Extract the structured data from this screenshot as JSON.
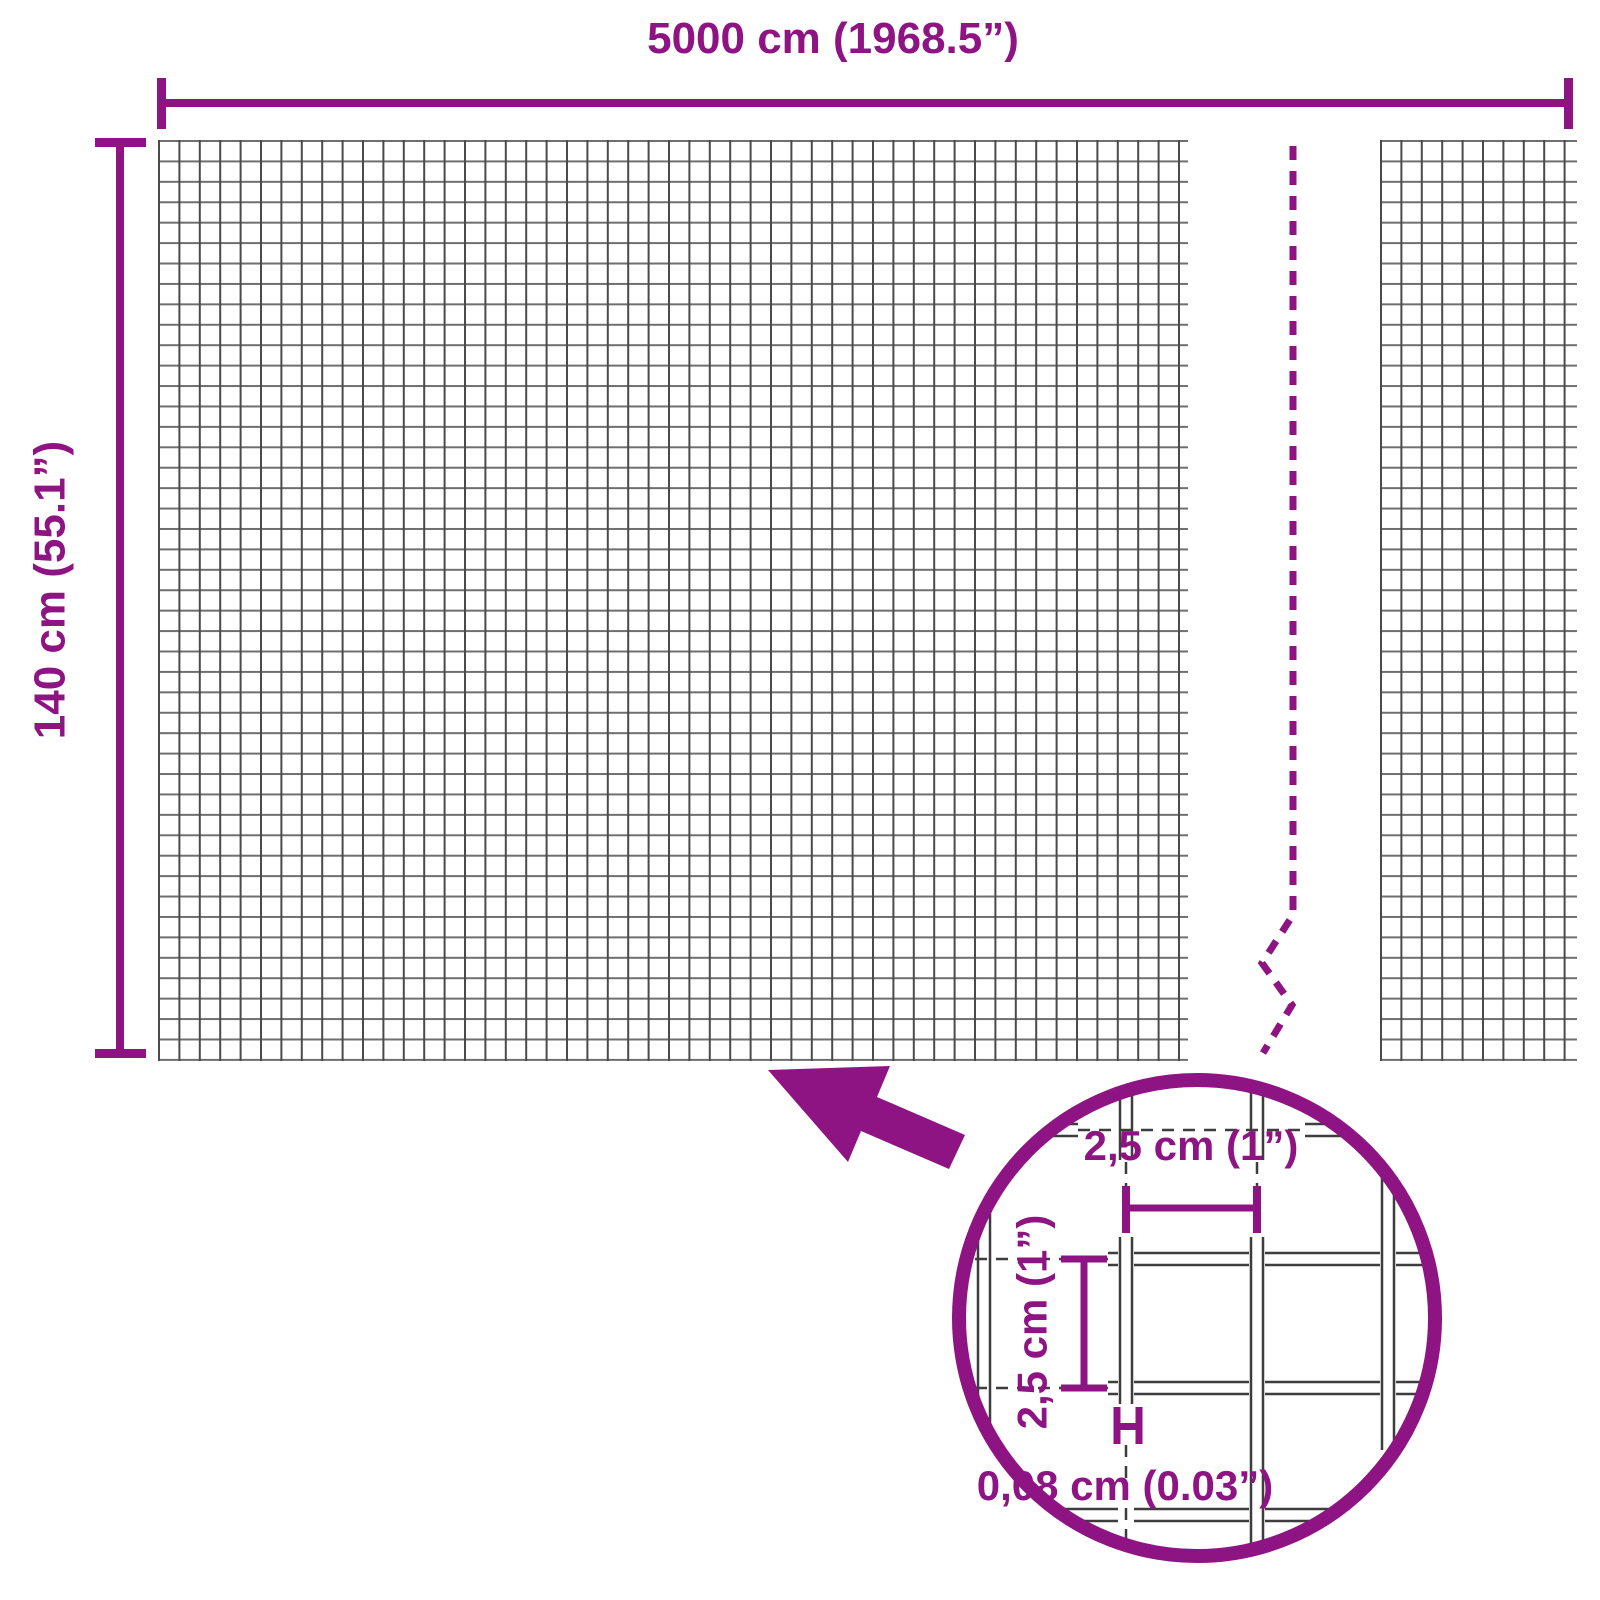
{
  "diagram": {
    "type": "product-dimension-diagram",
    "overall": {
      "width_label": "5000 cm (1968.5”)",
      "height_label": "140 cm (55.1”)"
    },
    "detail_inset": {
      "mesh_opening_width_label": "2,5 cm (1”)",
      "mesh_opening_height_label": "2,5 cm (1”)",
      "wire_thickness_label": "0,08 cm (0.03”)"
    },
    "colors": {
      "accent": "#8E1383",
      "grid_vertical_line": "#4A4A4A",
      "grid_horizontal_line": "#6F6F6F",
      "detail_wire_line": "#3D3D3D",
      "background": "#FFFFFF"
    }
  }
}
